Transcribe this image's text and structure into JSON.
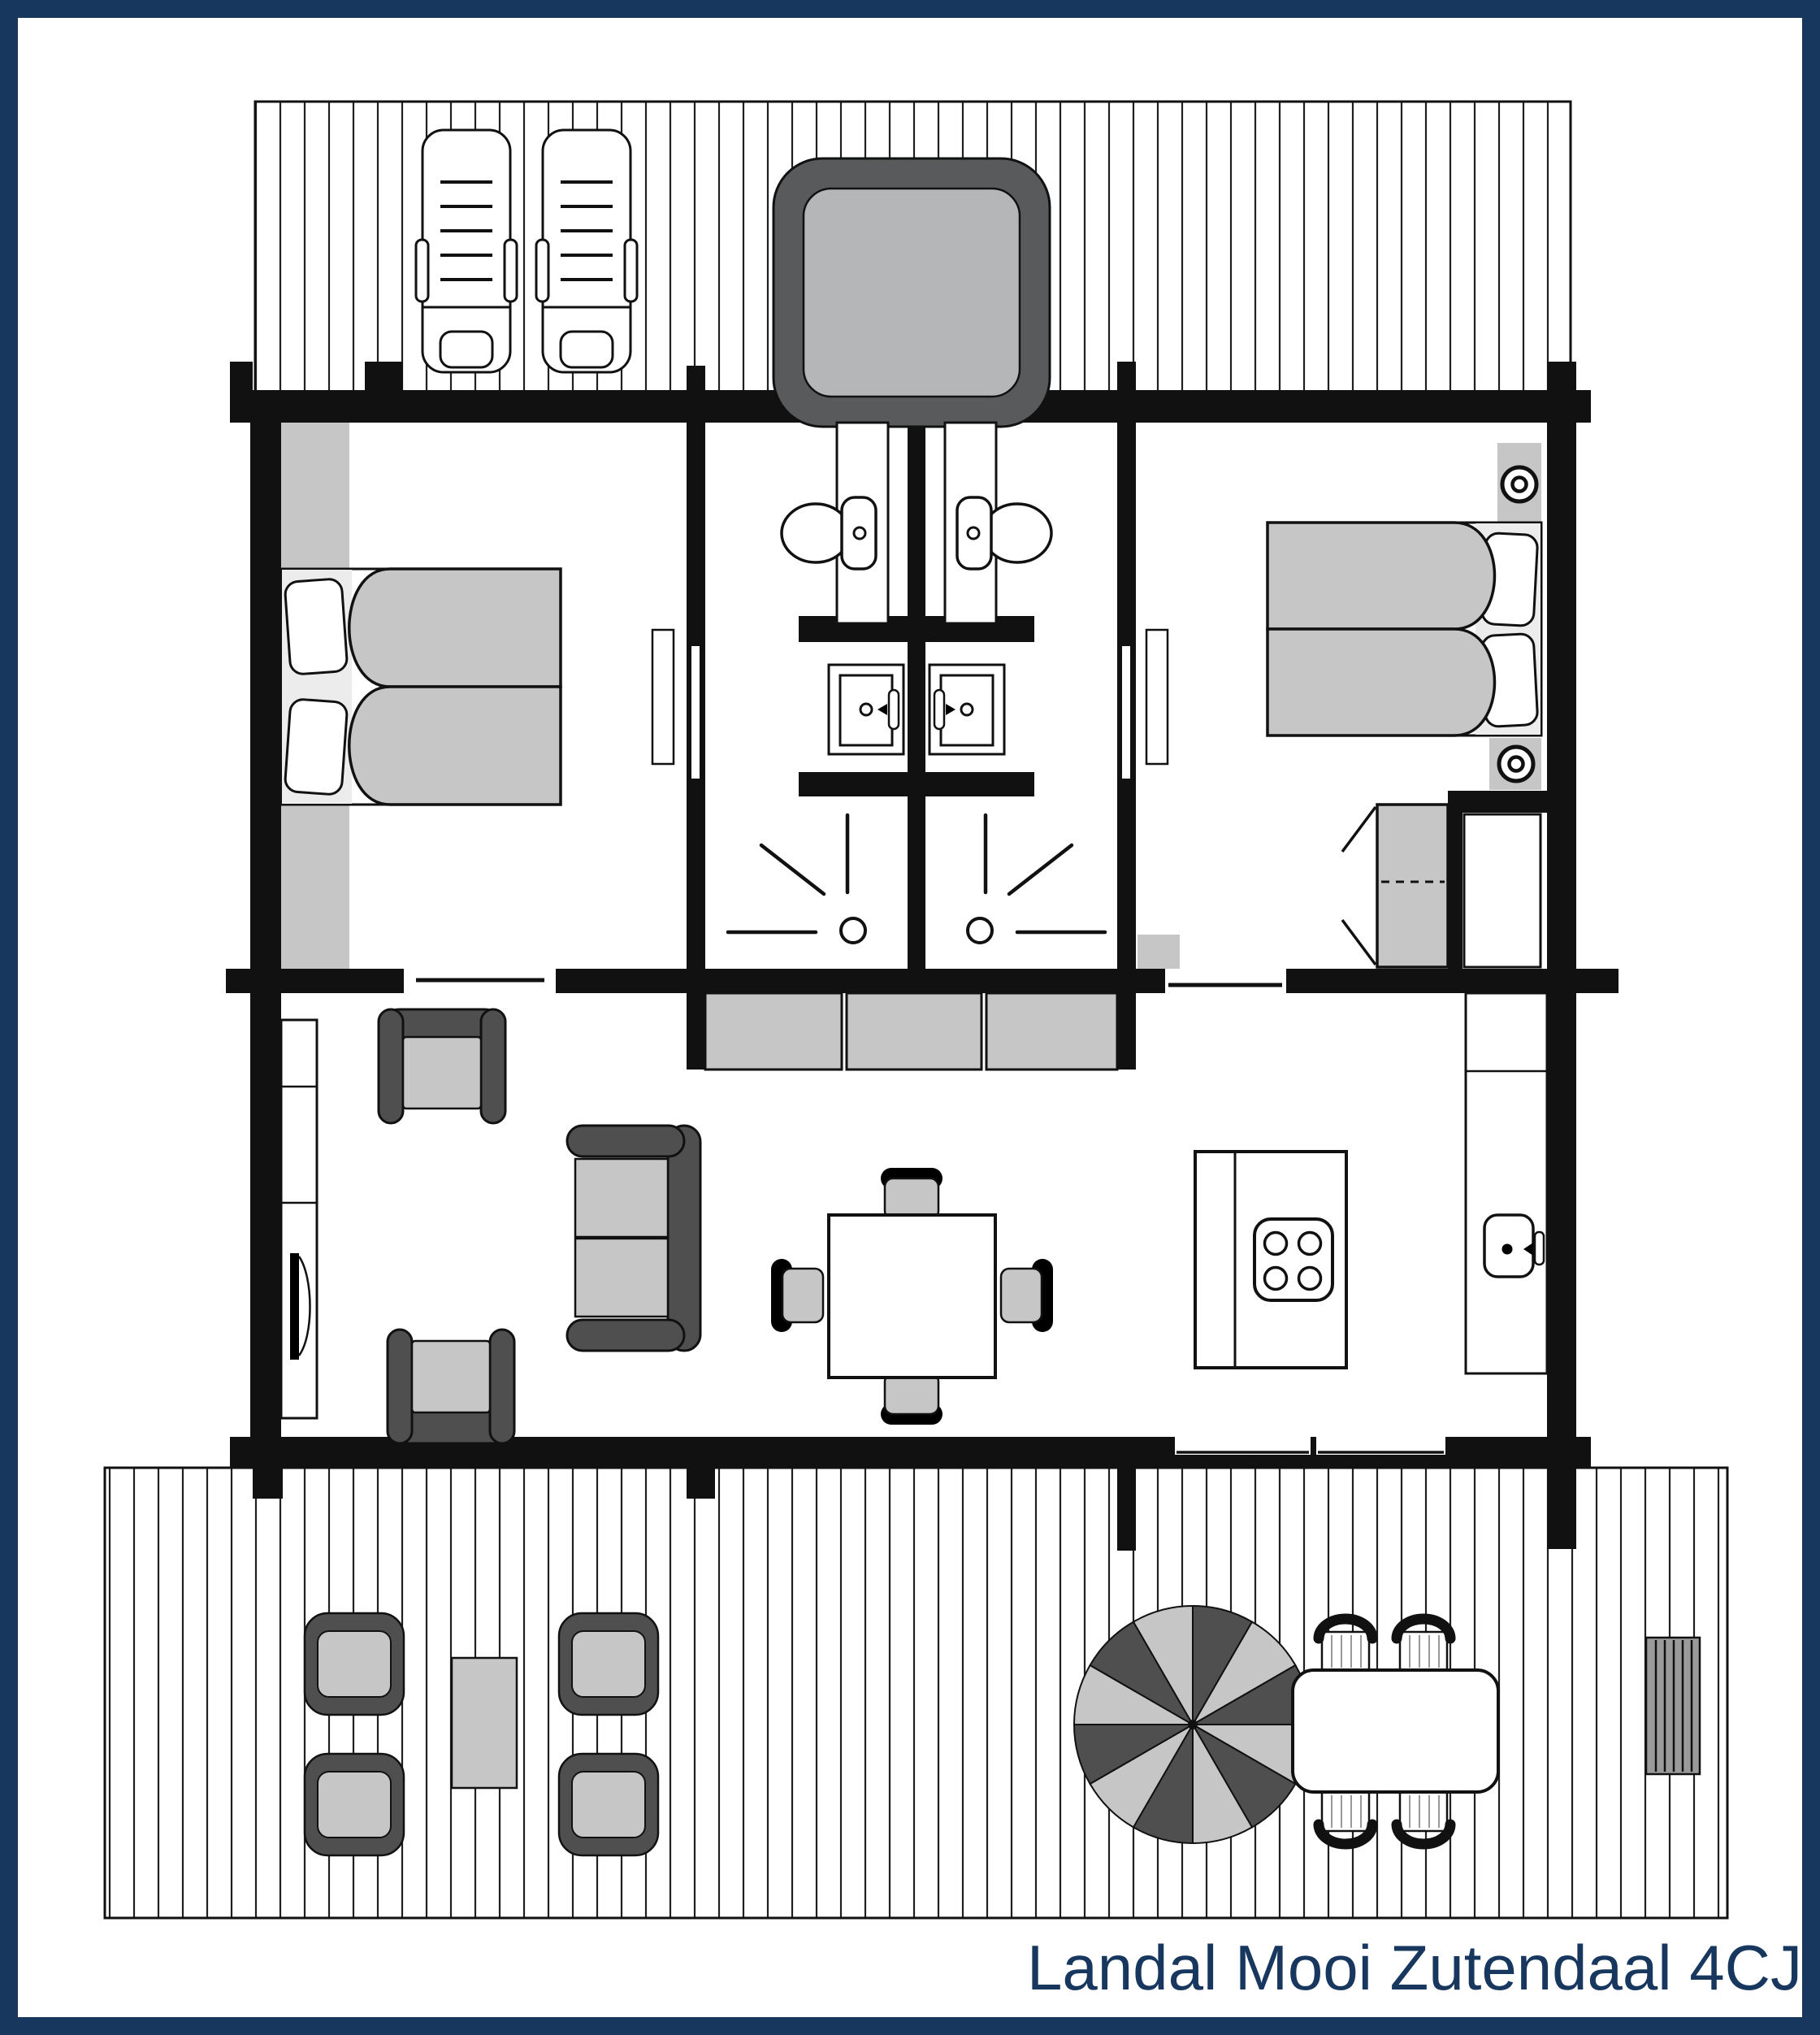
{
  "title": {
    "text": "Landal Mooi Zutendaal 4CJ"
  },
  "colors": {
    "navy": "#17375e",
    "wall": "#111111",
    "light": "#c6c6c6",
    "mid": "#9a9a9b",
    "dark": "#4f4f4f",
    "dark2": "#595a5c",
    "pillow": "#ececec",
    "tub": "#b5b6b8",
    "plank": "#202020"
  },
  "floorplan": {
    "type": "holiday-lodge-top-view",
    "areas": [
      {
        "name": "top-terrace",
        "kind": "wood deck",
        "furniture": [
          "sun-lounger",
          "sun-lounger",
          "hot-tub"
        ]
      },
      {
        "name": "bedroom-left",
        "kind": "bedroom",
        "furniture": [
          "double-bed",
          "headboard-cabinets",
          "door-leaf"
        ]
      },
      {
        "name": "bathroom-left",
        "kind": "bathroom",
        "furniture": [
          "toilet",
          "washbasin",
          "shower"
        ]
      },
      {
        "name": "bathroom-right",
        "kind": "bathroom",
        "furniture": [
          "toilet",
          "washbasin",
          "shower"
        ]
      },
      {
        "name": "bedroom-right",
        "kind": "bedroom",
        "furniture": [
          "double-bed",
          "nightstand-with-lamp",
          "nightstand-with-lamp",
          "wardrobe-folding-doors",
          "closet-nook",
          "door-leaf"
        ]
      },
      {
        "name": "living-kitchen",
        "kind": "open living room with kitchen",
        "furniture": [
          "tall-cabinet-with-door",
          "armchair",
          "armchair",
          "sofa-two-seat",
          "sideboard-3-sections",
          "dining-table",
          "dining-chair",
          "dining-chair",
          "dining-chair",
          "dining-chair",
          "kitchen-island-with-cooktop",
          "kitchen-counter-with-sink"
        ]
      },
      {
        "name": "bottom-terrace",
        "kind": "wood deck",
        "furniture": [
          "lounge-chair",
          "lounge-chair",
          "lounge-chair",
          "lounge-chair",
          "coffee-table",
          "parasol",
          "garden-table",
          "garden-chair",
          "garden-chair",
          "garden-chair",
          "garden-chair",
          "garden-bench"
        ]
      }
    ],
    "wall_openings": [
      "bedroom-left-to-bathroom-left-door",
      "bedroom-right-to-bathroom-right-door",
      "window-below-bedroom-left",
      "sliding-door-below-bedroom-right",
      "terrace-doors-kitchen-side"
    ]
  }
}
